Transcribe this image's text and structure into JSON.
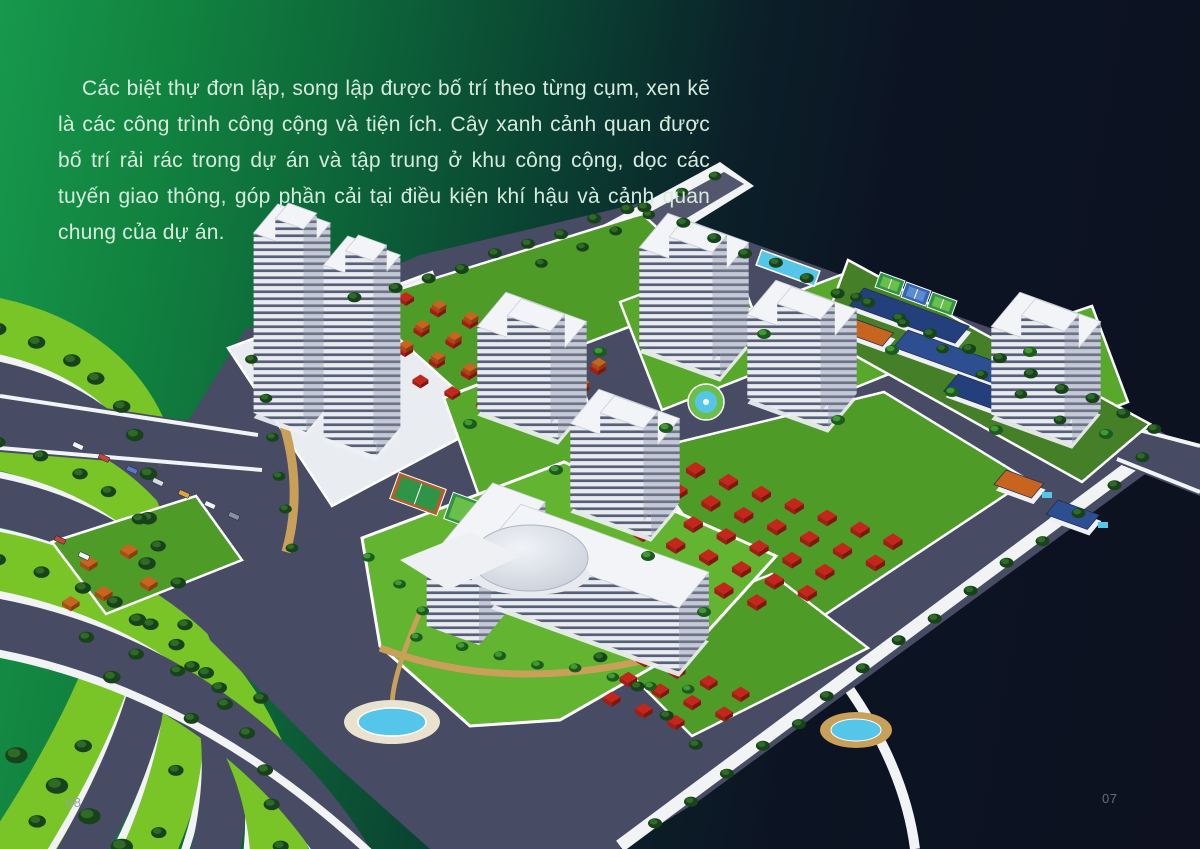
{
  "page": {
    "paragraph": "Các biệt thự đơn lập, song lập được bố trí theo từng cụm, xen kẽ là các công trình công cộng và tiện ích. Cây xanh cảnh quan được bố trí rải rác trong dự án và tập trung ở khu công cộng, dọc các tuyến giao thông, góp phần cải tại điều kiện khí hậu và cảnh quan chung của dự án.",
    "page_number_left": "08",
    "page_number_right": "07"
  },
  "colors": {
    "gradient_left": "#17984d",
    "gradient_right": "#0d1120",
    "paragraph_text": "#d6eadd",
    "page_number_left": "#99a0ac",
    "page_number_right": "#646b7c",
    "road": "#474b63",
    "sidewalk": "#f2f3f5",
    "median_grass": "#79c426",
    "block_grass": "#4f9b28",
    "lawn_grass": "#63b430",
    "tree_dark": "#17421a",
    "tree_highlight": "#2d6b26",
    "tree_bright": "#3f9a33",
    "building_face": "#e9ebf0",
    "building_side": "#c4c9d6",
    "building_roof": "#f3f4f7",
    "window_tint": "#566079",
    "villa_roof_red": "#c5261c",
    "villa_roof_orange": "#c7641f",
    "school_roof_blue": "#2d4f92",
    "school_roof_navy": "#24407c",
    "court_green": "#2f9447",
    "court_inner_green": "#6abf49",
    "court_blue": "#3766b0",
    "court_clay": "#b65c2a",
    "pool_water": "#55c6e9",
    "path_tan": "#c8a05a",
    "dome": "#c9cfda"
  }
}
